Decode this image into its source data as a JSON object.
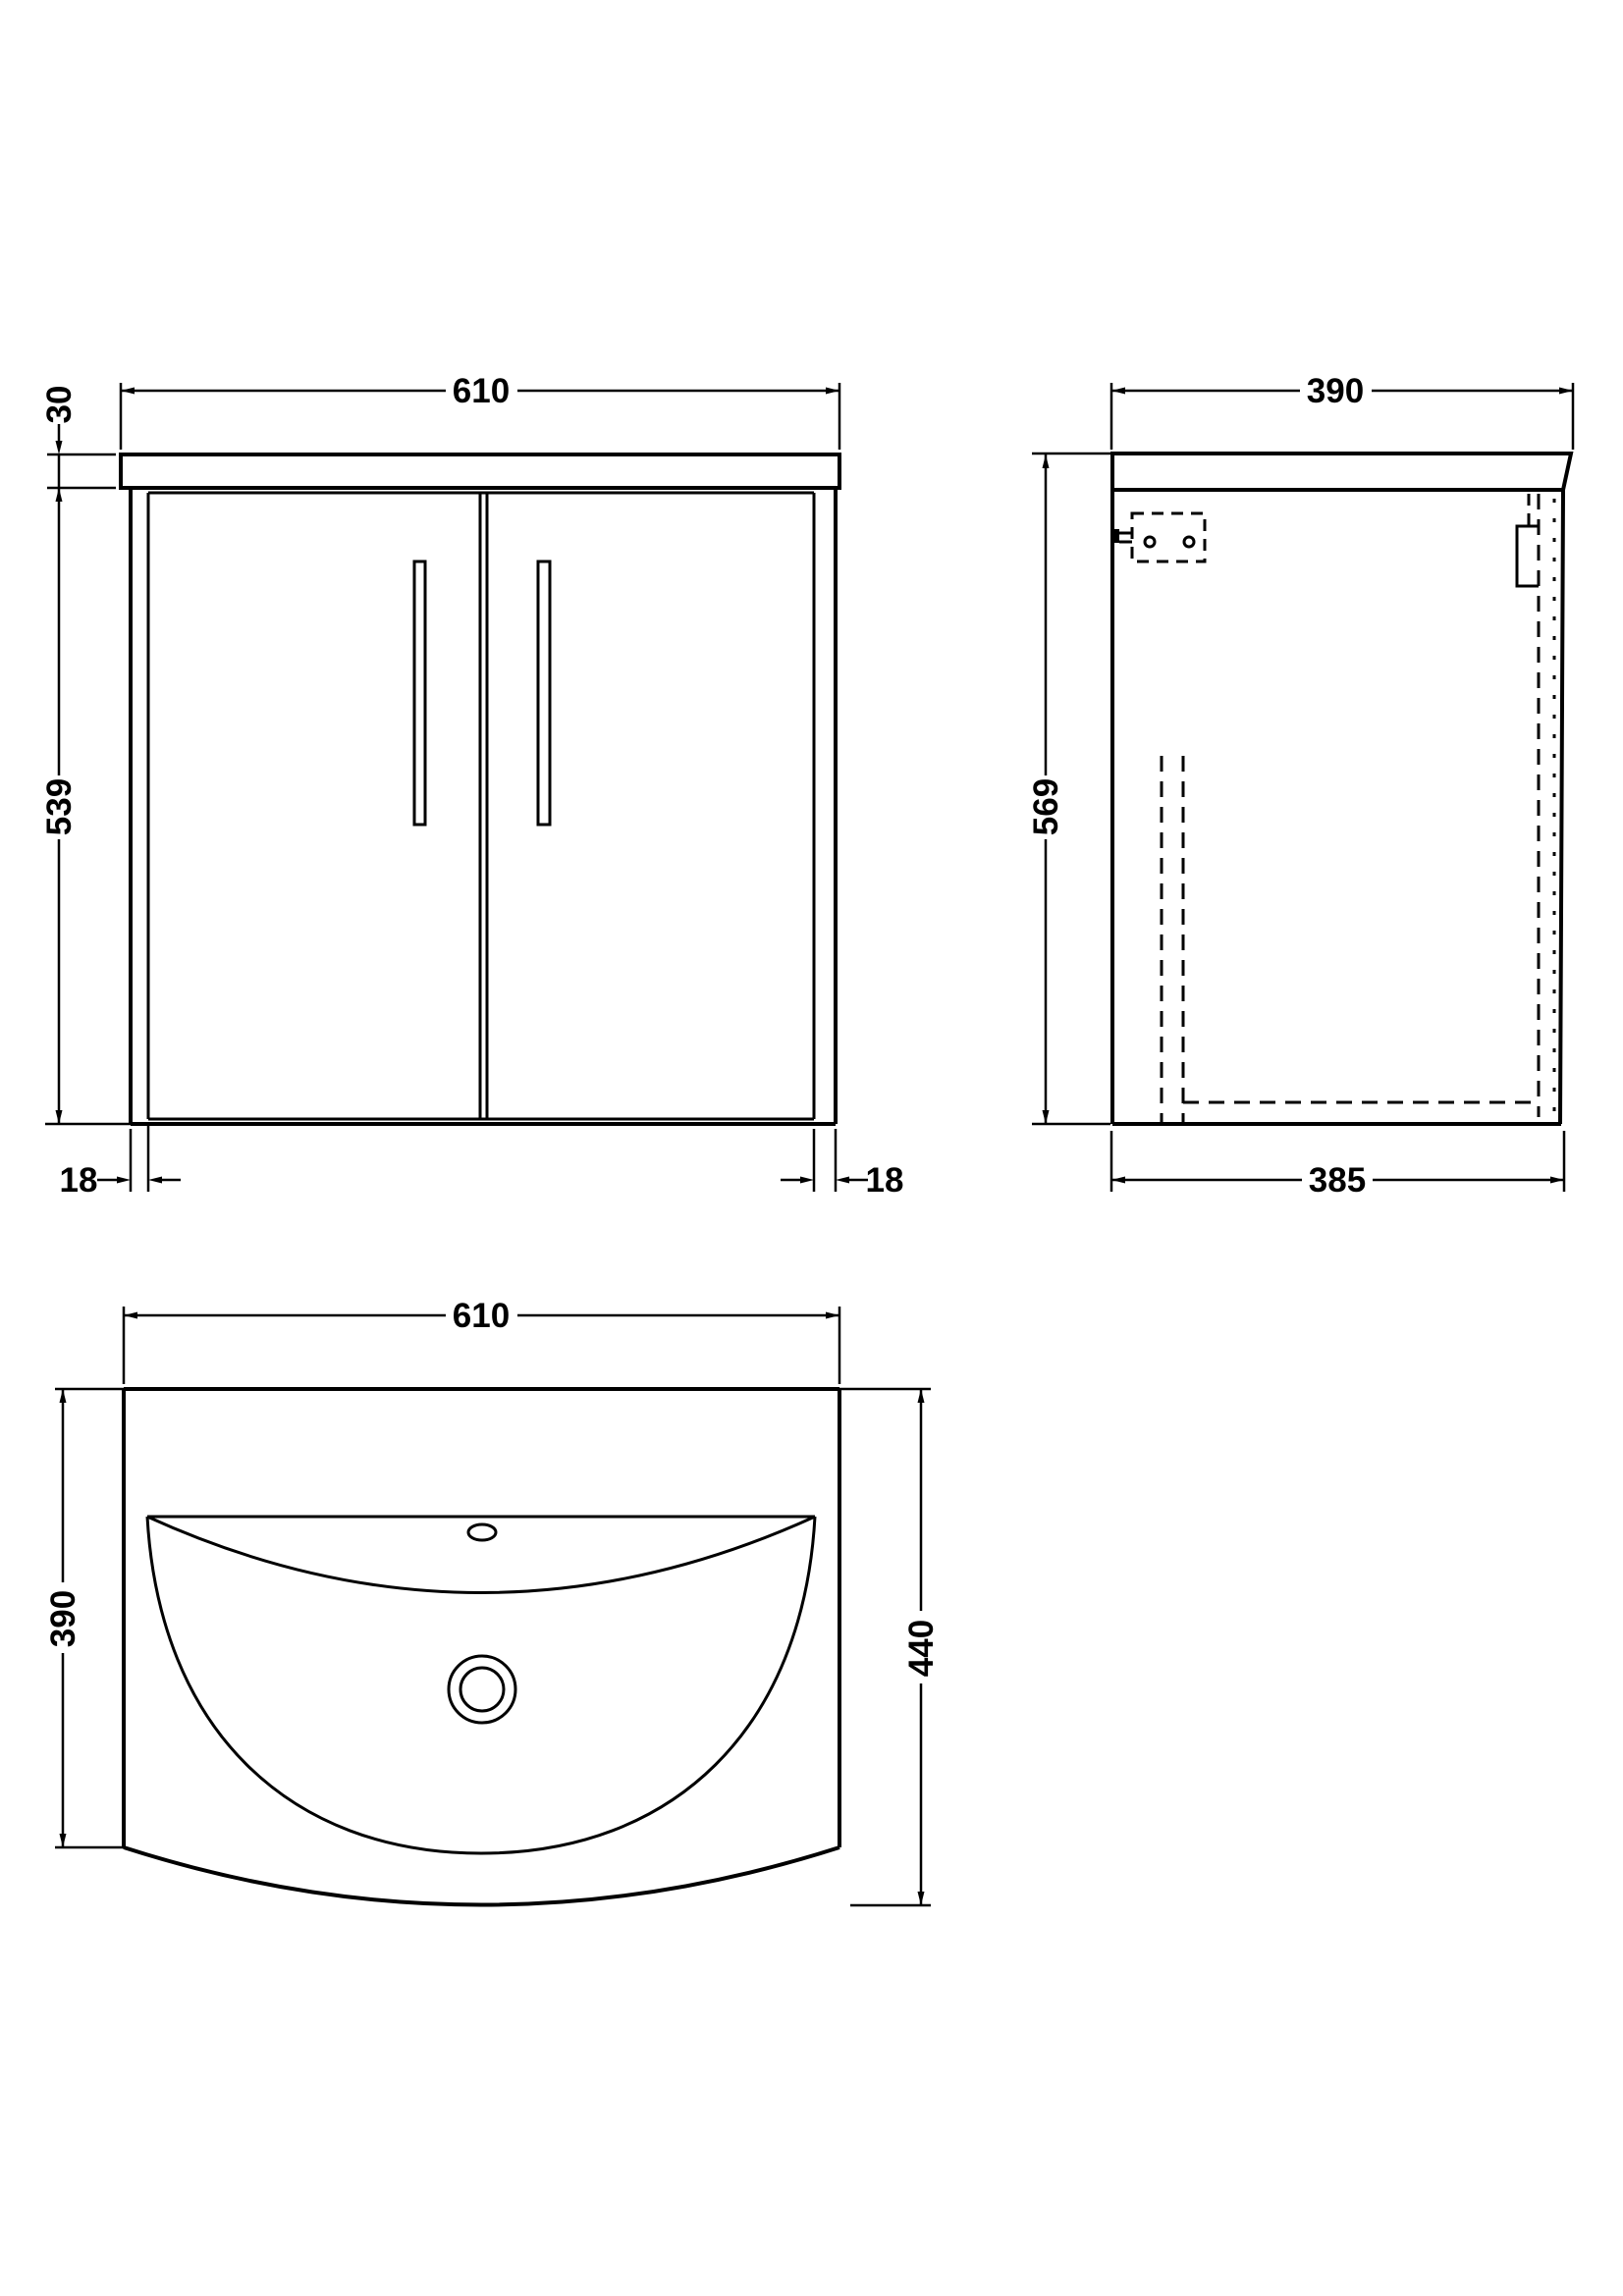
{
  "drawing": {
    "background_color": "#ffffff",
    "line_color": "#000000",
    "views": {
      "front": {
        "top_width": "610",
        "counter_thickness": "30",
        "cabinet_height": "539",
        "left_panel_thickness": "18",
        "right_panel_thickness": "18"
      },
      "side": {
        "top_depth": "390",
        "overall_height": "569",
        "bottom_depth": "385"
      },
      "plan": {
        "top_width": "610",
        "side_depth": "390",
        "overall_depth": "440"
      }
    }
  }
}
